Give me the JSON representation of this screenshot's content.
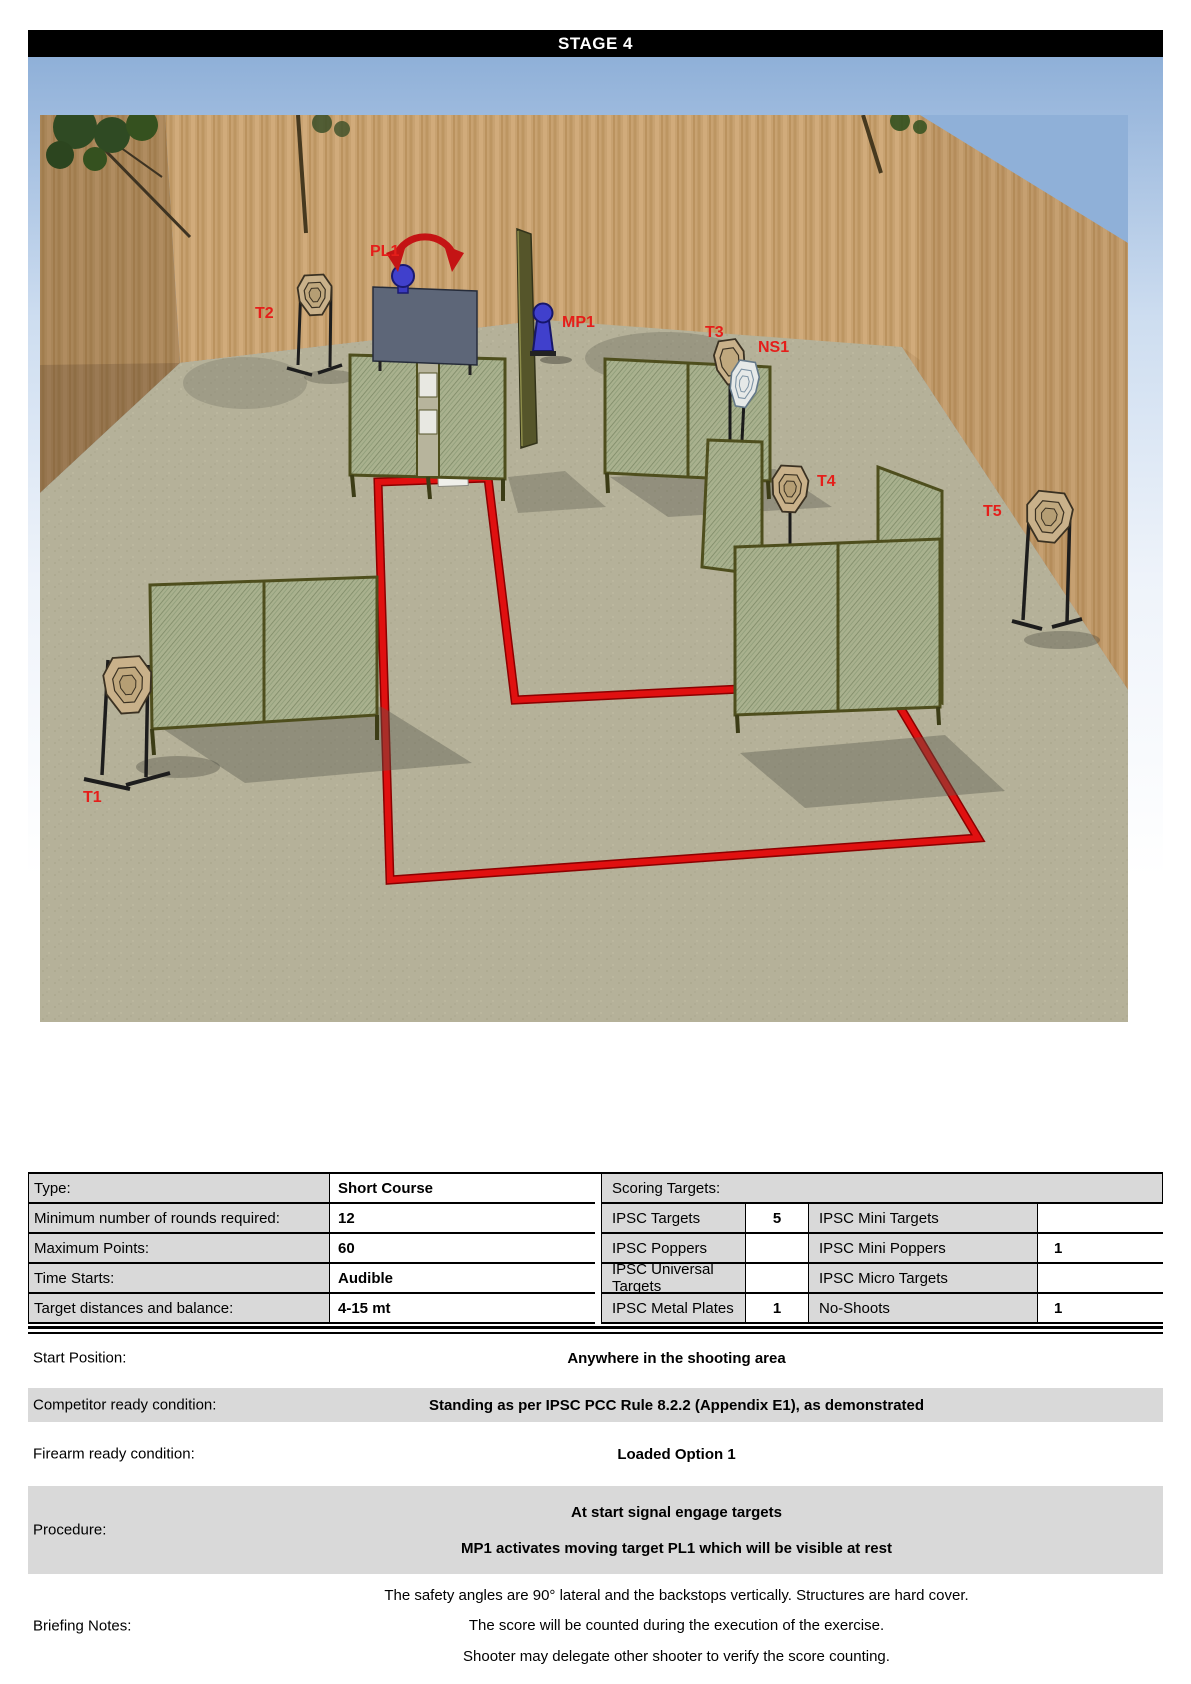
{
  "title": "STAGE 4",
  "scene": {
    "labels": [
      {
        "id": "PL1",
        "text": "PL1"
      },
      {
        "id": "T2",
        "text": "T2"
      },
      {
        "id": "MP1",
        "text": "MP1"
      },
      {
        "id": "T3",
        "text": "T3"
      },
      {
        "id": "NS1",
        "text": "NS1"
      },
      {
        "id": "T4",
        "text": "T4"
      },
      {
        "id": "T5",
        "text": "T5"
      },
      {
        "id": "T1",
        "text": "T1"
      }
    ],
    "colors": {
      "label_red": "#e51e1a",
      "fault_line": "#e01010",
      "sky": "#8fb0d8",
      "ground": "#b5b199",
      "berm": "#c8a271",
      "mesh_wall": "#a9b18e",
      "barrier_panel": "#5d6678",
      "popper_blue": "#4040cc",
      "target_cardboard": "#c9b18a",
      "no_shoot": "#e6e9e8"
    }
  },
  "info_table": {
    "rows": [
      {
        "label": "Type:",
        "value": "Short Course"
      },
      {
        "label": "Minimum number of rounds required:",
        "value": "12"
      },
      {
        "label": "Maximum Points:",
        "value": "60"
      },
      {
        "label": "Time Starts:",
        "value": "Audible"
      },
      {
        "label": "Target distances and balance:",
        "value": "4-15 mt"
      }
    ],
    "scoring": {
      "header": "Scoring Targets:",
      "rows": [
        {
          "name": "IPSC Targets",
          "count": "5",
          "name2": "IPSC Mini Targets",
          "count2": ""
        },
        {
          "name": "IPSC Poppers",
          "count": "",
          "name2": "IPSC Mini Poppers",
          "count2": "1"
        },
        {
          "name": "IPSC Universal Targets",
          "count": "",
          "name2": "IPSC Micro Targets",
          "count2": ""
        },
        {
          "name": "IPSC Metal Plates",
          "count": "1",
          "name2": "No-Shoots",
          "count2": "1"
        }
      ]
    }
  },
  "details": {
    "rows": [
      {
        "label": "Start Position:",
        "lines": [
          "Anywhere in the shooting area"
        ]
      },
      {
        "label": "Competitor ready condition:",
        "lines": [
          "Standing as per IPSC PCC Rule 8.2.2 (Appendix E1), as demonstrated"
        ]
      },
      {
        "label": "Firearm ready condition:",
        "lines": [
          "Loaded Option 1"
        ]
      },
      {
        "label": "Procedure:",
        "lines": [
          "At start signal engage targets",
          "MP1 activates moving target PL1 which will be visible at rest"
        ]
      },
      {
        "label": "Briefing Notes:",
        "lines": [
          "The safety angles are 90° lateral and the backstops vertically. Structures are hard cover.",
          "The score will be counted during the execution of the exercise.",
          "Shooter may delegate other shooter to verify the score counting."
        ]
      }
    ]
  }
}
